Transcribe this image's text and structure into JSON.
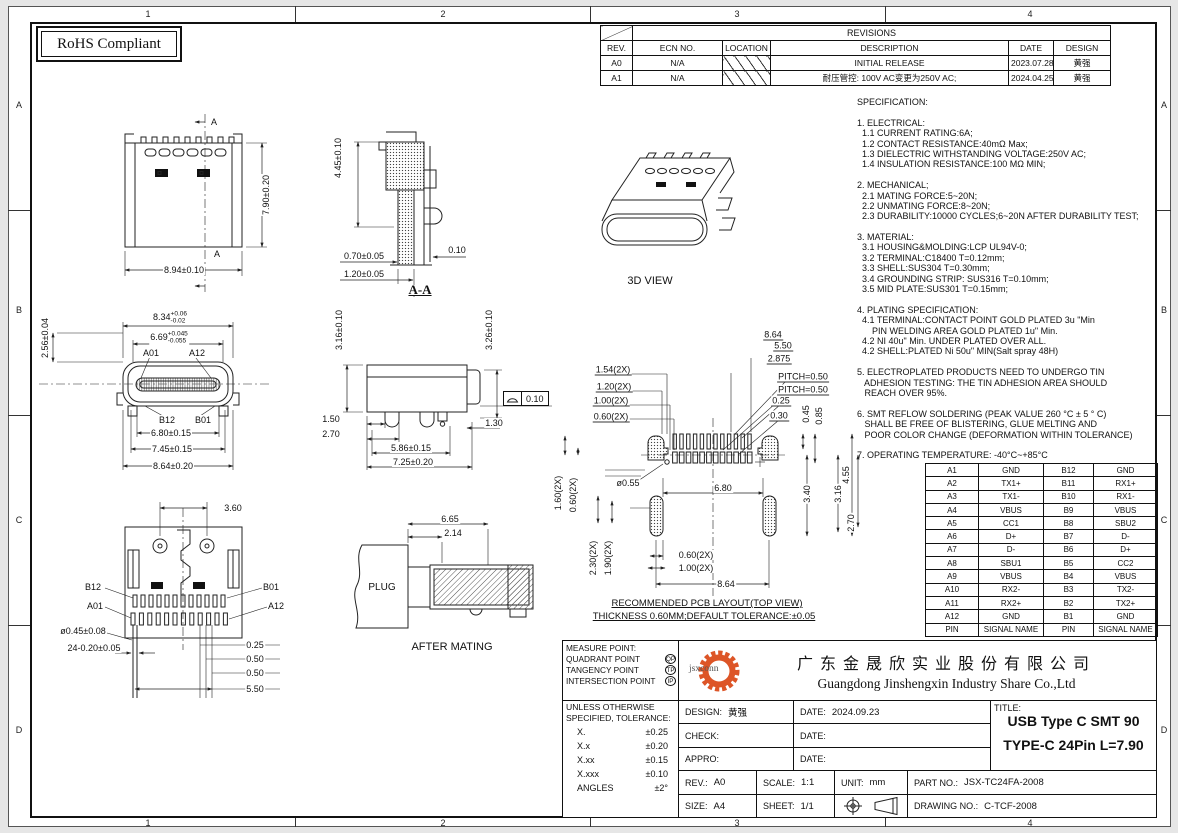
{
  "sheet": {
    "rohs": "RoHS Compliant",
    "zone_cols": [
      "1",
      "2",
      "3",
      "4"
    ],
    "zone_rows": [
      "A",
      "B",
      "C",
      "D"
    ]
  },
  "revisions": {
    "title": "REVISIONS",
    "headers": [
      "REV.",
      "ECN NO.",
      "LOCATION",
      "DESCRIPTION",
      "DATE",
      "DESIGN"
    ],
    "rows": [
      {
        "rev": "A0",
        "ecn": "N/A",
        "description": "INITIAL RELEASE",
        "date": "2023.07.28",
        "design": "黄强"
      },
      {
        "rev": "A1",
        "ecn": "N/A",
        "description": "耐压管控: 100V AC变更为250V AC;",
        "date": "2024.04.25",
        "design": "黄强"
      }
    ]
  },
  "spec": {
    "lines": [
      "SPECIFICATION:",
      "",
      "1. ELECTRICAL:",
      "  1.1 CURRENT RATING:6A;",
      "  1.2 CONTACT RESISTANCE:40mΩ Max;",
      "  1.3 DIELECTRIC WITHSTANDING VOLTAGE:250V AC;",
      "  1.4 INSULATION RESISTANCE:100 MΩ MIN;",
      "",
      "2. MECHANICAL;",
      "  2.1 MATING FORCE:5~20N;",
      "  2.2 UNMATING FORCE:8~20N;",
      "  2.3 DURABILITY:10000 CYCLES;6~20N AFTER DURABILITY TEST;",
      "",
      "3. MATERIAL:",
      "  3.1 HOUSING&MOLDING:LCP UL94V-0;",
      "  3.2 TERMINAL:C18400 T=0.12mm;",
      "  3.3 SHELL:SUS304 T=0.30mm;",
      "  3.4 GROUNDING STRIP: SUS316 T=0.10mm;",
      "  3.5 MID PLATE:SUS301 T=0.15mm;",
      "",
      "4. PLATING SPECIFICATION:",
      "  4.1 TERMINAL:CONTACT POINT GOLD PLATED 3u \"Min",
      "      PIN WELDING AREA GOLD PLATED 1u\" Min.",
      "  4.2 NI 40u\" Min. UNDER PLATED OVER ALL.",
      "  4.2 SHELL:PLATED Ni 50u\" MIN(Salt spray 48H)",
      "",
      "5. ELECTROPLATED PRODUCTS NEED TO UNDERGO TIN",
      "   ADHESION TESTING: THE TIN ADHESION AREA SHOULD",
      "   REACH OVER 95%.",
      "",
      "6. SMT REFLOW SOLDERING (PEAK VALUE 260 °C ± 5 ° C)",
      "   SHALL BE FREE OF BLISTERING, GLUE MELTING AND",
      "   POOR COLOR CHANGE (DEFORMATION WITHIN TOLERANCE)",
      "",
      "7. OPERATING TEMPERATURE: -40°C~+85°C"
    ]
  },
  "views": {
    "top": {
      "section_mark": "A",
      "dim_h": "7.90±0.20",
      "dim_w": "8.94±0.10"
    },
    "aa": {
      "label": "A-A",
      "dim_h": "4.45±0.10",
      "dim_a": "0.70±0.05",
      "dim_b": "1.20±0.05",
      "dim_c": "0.10"
    },
    "iso": {
      "label": "3D VIEW"
    },
    "front": {
      "dim_h": "2.56±0.04",
      "w1": "8.34",
      "w1_up": "+0.06",
      "w1_dn": "-0.02",
      "w2": "6.69",
      "w2_up": "+0.045",
      "w2_dn": "-0.055",
      "pin_a01": "A01",
      "pin_a12": "A12",
      "pin_b12": "B12",
      "pin_b01": "B01",
      "d1": "6.80±0.15",
      "d2": "7.45±0.15",
      "d3": "8.64±0.20"
    },
    "side": {
      "h1": "3.16±0.10",
      "h2": "3.26±0.10",
      "d1": "1.50",
      "d2": "2.70",
      "d3": "5.86±0.15",
      "d4": "7.25±0.20",
      "d5": "1.30",
      "profile": "0.10"
    },
    "pcb": {
      "t1": "8.64",
      "t2": "5.50",
      "t3": "2.875",
      "pitch1": "PITCH=0.50",
      "pitch2": "PITCH=0.50",
      "r1": "0.25",
      "r2": "0.30",
      "r3": "0.45",
      "r4": "0.85",
      "l1": "1.54(2X)",
      "l2": "1.20(2X)",
      "l3": "1.00(2X)",
      "l4": "0.60(2X)",
      "l5": "1.60(2X)",
      "l6": "0.60(2X)",
      "l7": "2.30(2X)",
      "l8": "1.90(2X)",
      "hole": "ø0.55",
      "mid": "6.80",
      "v1": "3.40",
      "v2": "3.16",
      "v3": "4.55",
      "v4": "2.70",
      "b1": "0.60(2X)",
      "b2": "1.00(2X)",
      "b3": "8.64",
      "cap1": "RECOMMENDED PCB LAYOUT(TOP VIEW)",
      "cap2": "THICKNESS 0.60MM;DEFAULT TOLERANCE:±0.05"
    },
    "bottom": {
      "t1": "3.60",
      "pin_b12": "B12",
      "pin_b01": "B01",
      "pin_a01": "A01",
      "pin_a12": "A12",
      "d1": "ø0.45±0.08",
      "d2": "24-0.20±0.05",
      "r1": "0.25",
      "r2": "0.50",
      "r3": "0.50",
      "r4": "5.50"
    },
    "mating": {
      "plug": "PLUG",
      "d1": "6.65",
      "d2": "2.14",
      "caption": "AFTER MATING"
    }
  },
  "pin_table": {
    "rows": [
      [
        "A1",
        "GND",
        "B12",
        "GND"
      ],
      [
        "A2",
        "TX1+",
        "B11",
        "RX1+"
      ],
      [
        "A3",
        "TX1-",
        "B10",
        "RX1-"
      ],
      [
        "A4",
        "VBUS",
        "B9",
        "VBUS"
      ],
      [
        "A5",
        "CC1",
        "B8",
        "SBU2"
      ],
      [
        "A6",
        "D+",
        "B7",
        "D-"
      ],
      [
        "A7",
        "D-",
        "B6",
        "D+"
      ],
      [
        "A8",
        "SBU1",
        "B5",
        "CC2"
      ],
      [
        "A9",
        "VBUS",
        "B4",
        "VBUS"
      ],
      [
        "A10",
        "RX2-",
        "B3",
        "TX2-"
      ],
      [
        "A11",
        "RX2+",
        "B2",
        "TX2+"
      ],
      [
        "A12",
        "GND",
        "B1",
        "GND"
      ]
    ],
    "footer": [
      "PIN",
      "SIGNAL NAME",
      "PIN",
      "SIGNAL NAME"
    ]
  },
  "title_block": {
    "measure": {
      "title": "MEASURE POINT:",
      "rows": [
        {
          "label": "QUADRANT POINT",
          "code": "QP"
        },
        {
          "label": "TANGENCY POINT",
          "code": "TP"
        },
        {
          "label": "INTERSECTION POINT",
          "code": "IP"
        }
      ]
    },
    "tolerance": {
      "l1": "UNLESS OTHERWISE",
      "l2": "SPECIFIED, TOLERANCE:",
      "rows": [
        [
          "X.",
          "±0.25"
        ],
        [
          "X.x",
          "±0.20"
        ],
        [
          "X.xx",
          "±0.15"
        ],
        [
          "X.xxx",
          "±0.10"
        ],
        [
          "ANGLES",
          "±2°"
        ]
      ]
    },
    "company": {
      "logo": "jsxconn",
      "cn": "广东金晟欣实业股份有限公司",
      "en": "Guangdong Jinshengxin Industry Share Co.,Ltd"
    },
    "design_label": "DESIGN:",
    "design": "黄强",
    "date1_label": "DATE:",
    "date1": "2024.09.23",
    "check_label": "CHECK:",
    "date2_label": "DATE:",
    "date2": "",
    "appro_label": "APPRO:",
    "date3_label": "DATE:",
    "date3": "",
    "title_label": "TITLE:",
    "title1": "USB Type C SMT 90",
    "title2": "TYPE-C 24Pin L=7.90",
    "rev_label": "REV.:",
    "rev": "A0",
    "scale_label": "SCALE:",
    "scale": "1:1",
    "unit_label": "UNIT:",
    "unit": "mm",
    "part_label": "PART NO.:",
    "part": "JSX-TC24FA-2008",
    "size_label": "SIZE:",
    "size": "A4",
    "sheet_label": "SHEET:",
    "sheet": "1/1",
    "drawing_label": "DRAWING NO.:",
    "drawing": "C-TCF-2008"
  }
}
